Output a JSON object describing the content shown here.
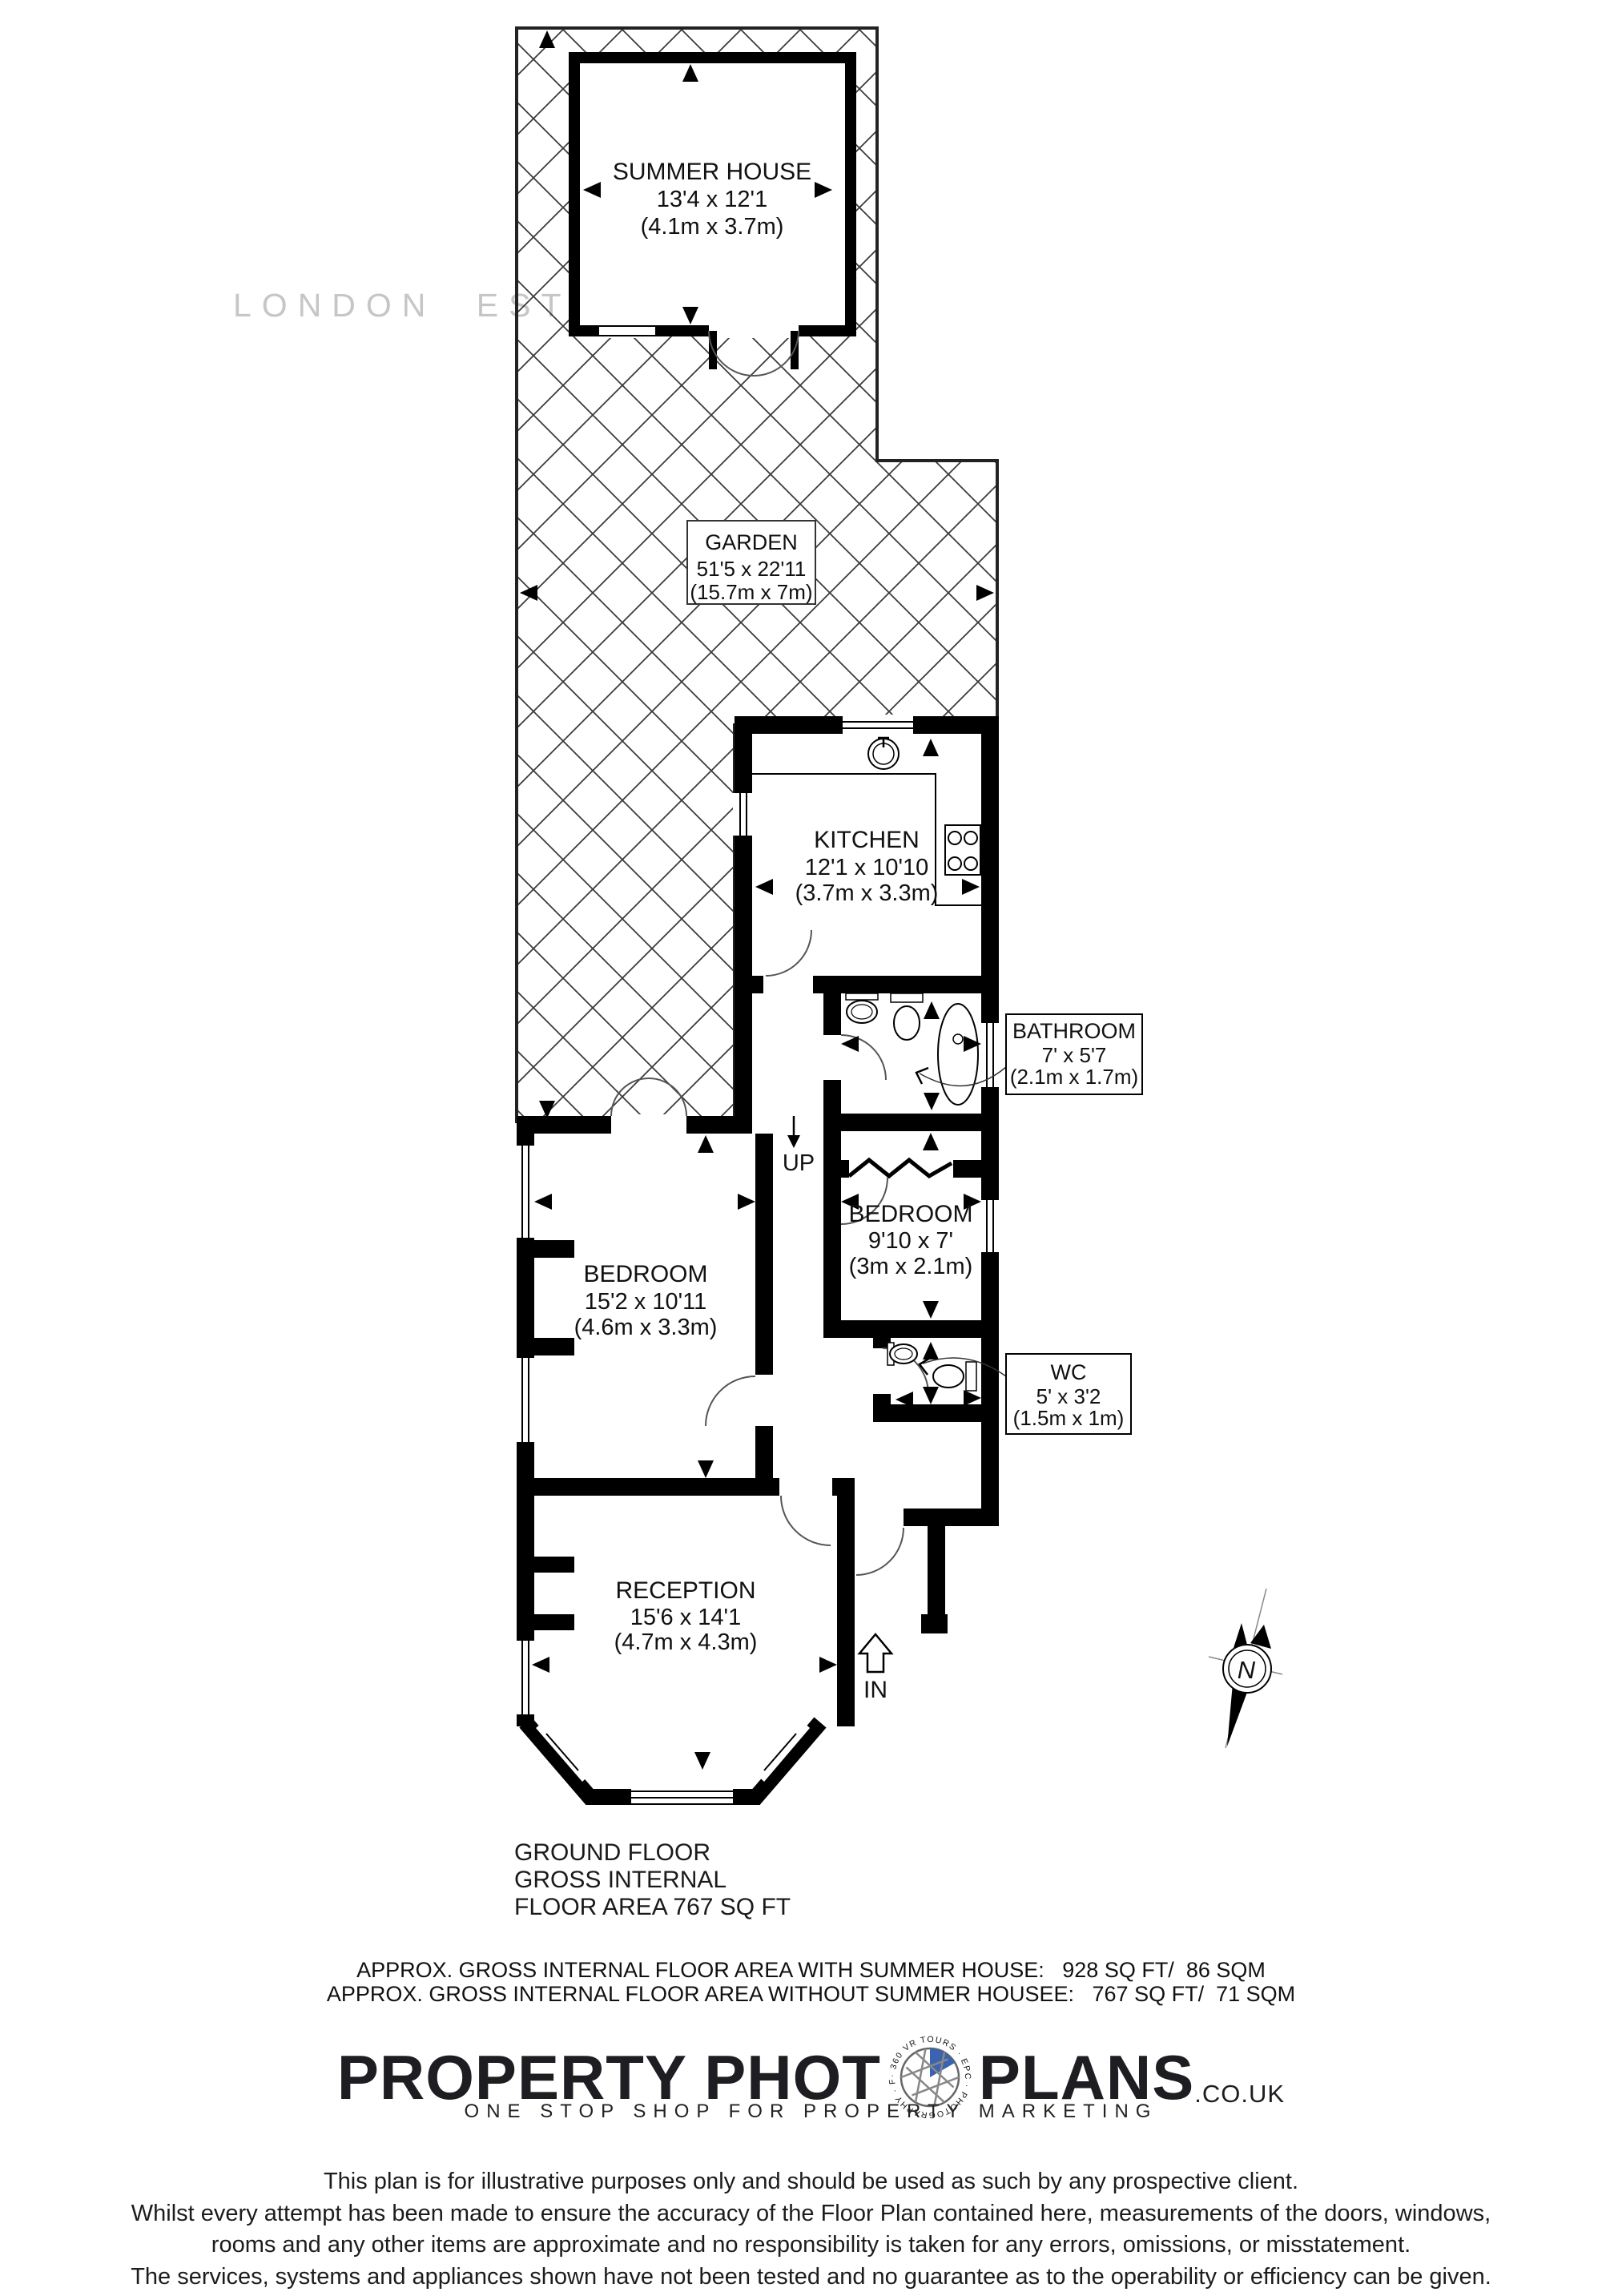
{
  "watermark": "LONDON ESTATES",
  "rooms": {
    "summer_house": {
      "name": "SUMMER HOUSE",
      "imperial": "13'4 x 12'1",
      "metric": "(4.1m x 3.7m)"
    },
    "garden": {
      "name": "GARDEN",
      "imperial": "51'5 x 22'11",
      "metric": "(15.7m x 7m)"
    },
    "kitchen": {
      "name": "KITCHEN",
      "imperial": "12'1 x 10'10",
      "metric": "(3.7m x 3.3m)"
    },
    "bathroom": {
      "name": "BATHROOM",
      "imperial": "7' x 5'7",
      "metric": "(2.1m x 1.7m)"
    },
    "bedroom_small": {
      "name": "BEDROOM",
      "imperial": "9'10 x 7'",
      "metric": "(3m x 2.1m)"
    },
    "wc": {
      "name": "WC",
      "imperial": "5' x 3'2",
      "metric": "(1.5m x 1m)"
    },
    "bedroom_large": {
      "name": "BEDROOM",
      "imperial": "15'2 x 10'11",
      "metric": "(4.6m x 3.3m)"
    },
    "reception": {
      "name": "RECEPTION",
      "imperial": "15'6 x 14'1",
      "metric": "(4.7m x 4.3m)"
    }
  },
  "annotations": {
    "up": "UP",
    "in": "IN",
    "north": "N"
  },
  "summary": {
    "line1": "GROUND FLOOR",
    "line2": "GROSS INTERNAL",
    "line3": "FLOOR AREA 767 SQ FT"
  },
  "approx": {
    "with_line": "APPROX. GROSS INTERNAL FLOOR AREA WITH SUMMER HOUSE:   928 SQ FT/  86 SQM",
    "without_line": "APPROX. GROSS INTERNAL FLOOR AREA WITHOUT SUMMER HOUSEE:   767 SQ FT/  71 SQM"
  },
  "brand": {
    "word1": "PROPERTY PHOT",
    "word2": "PLANS",
    "tld": ".CO.UK",
    "tagline": "ONE STOP SHOP FOR PROPERTY MARKETING",
    "ring_text": "· 360 VR TOURS · EPC · PHOTOGRAPHY · FLOOR PLANS"
  },
  "disclaimer": [
    "This plan is for illustrative purposes only and should be used as such by any prospective client.",
    "Whilst every attempt has been made to ensure the accuracy of the Floor Plan contained here, measurements of the doors, windows,",
    "rooms and any other items are approximate and no responsibility is taken for any errors, omissions, or misstatement.",
    "The services, systems and appliances shown have not been tested and no guarantee as to the operability or efficiency can be given."
  ],
  "colors": {
    "wall": "#000000",
    "hatch": "#3b3b3b",
    "watermark": "#c6c6c6",
    "brand_blue": "#3b63b0"
  }
}
